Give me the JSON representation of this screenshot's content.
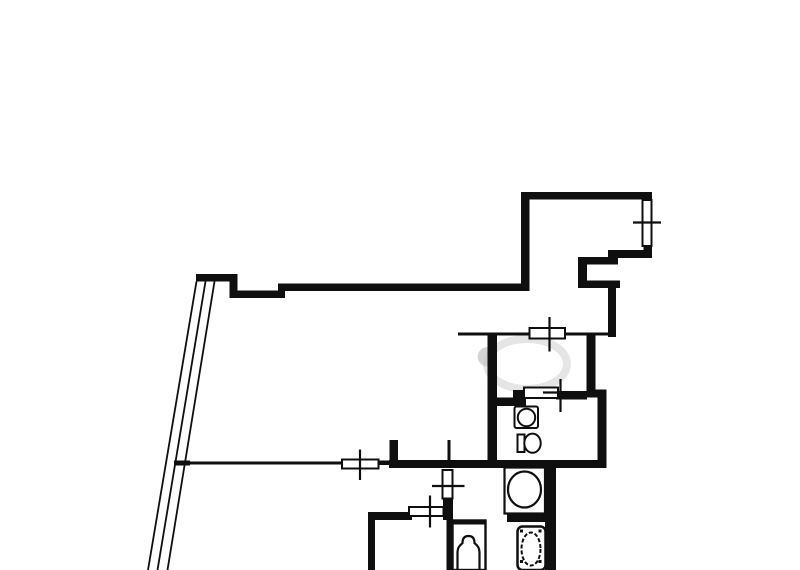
{
  "canvas": {
    "width": 800,
    "height": 570,
    "background": "#ffffff",
    "ink": "#0f0f0f"
  },
  "plan": {
    "description": "apartment-floor-plan",
    "layers": [
      {
        "name": "watermark",
        "shapes": [
          {
            "t": "e",
            "n": "watermark-ring",
            "cx": 527,
            "cy": 364,
            "rx": 40,
            "ry": 25,
            "sw": 8,
            "stroke": "#e5e5e5",
            "fill": "none"
          },
          {
            "t": "p",
            "n": "watermark-half-disc",
            "d": "M487.5,347 A9.5,9.5 0 0 0 487.5,366.5 Z",
            "fill": "#c8c8c8",
            "op": 0.8
          }
        ]
      },
      {
        "name": "walls-thick",
        "shapes": [
          {
            "t": "r",
            "n": "wall-roomA-top",
            "x": 521,
            "y": 192,
            "w": 131,
            "h": 7.5
          },
          {
            "t": "r",
            "n": "wall-roomA-left",
            "x": 521,
            "y": 192,
            "w": 8.5,
            "h": 99
          },
          {
            "t": "r",
            "n": "wall-roomA-right-top",
            "x": 643.5,
            "y": 192,
            "w": 8.5,
            "h": 10.5
          },
          {
            "t": "r",
            "n": "wall-roomA-right-bottom",
            "x": 643.5,
            "y": 245.5,
            "w": 8.5,
            "h": 12.5
          },
          {
            "t": "r",
            "n": "wall-roomA-bottom",
            "x": 608,
            "y": 250,
            "w": 44,
            "h": 8
          },
          {
            "t": "r",
            "n": "wall-step-a",
            "x": 608,
            "y": 250,
            "w": 10,
            "h": 14.5
          },
          {
            "t": "r",
            "n": "wall-step-b",
            "x": 578,
            "y": 257,
            "w": 40,
            "h": 7.5
          },
          {
            "t": "r",
            "n": "wall-step-c",
            "x": 578,
            "y": 257,
            "w": 9,
            "h": 31
          },
          {
            "t": "r",
            "n": "wall-step-d",
            "x": 578,
            "y": 280.5,
            "w": 42,
            "h": 7.5
          },
          {
            "t": "r",
            "n": "wall-hall-right-upper",
            "x": 608,
            "y": 280.5,
            "w": 8,
            "h": 56.5
          },
          {
            "t": "r",
            "n": "wall-main-top",
            "x": 281,
            "y": 283.5,
            "w": 248.5,
            "h": 7.5
          },
          {
            "t": "r",
            "n": "wall-notch-step",
            "x": 278,
            "y": 283.5,
            "w": 7,
            "h": 14.5
          },
          {
            "t": "r",
            "n": "wall-notch",
            "x": 233,
            "y": 290.5,
            "w": 48,
            "h": 7.5
          },
          {
            "t": "r",
            "n": "wall-notch-corner",
            "x": 229.5,
            "y": 274,
            "w": 8,
            "h": 24
          },
          {
            "t": "r",
            "n": "wall-left-stub",
            "x": 196,
            "y": 274,
            "w": 38.5,
            "h": 7.5
          },
          {
            "t": "r",
            "n": "wall-bottom-main",
            "x": 389,
            "y": 460,
            "w": 216.5,
            "h": 8
          },
          {
            "t": "r",
            "n": "wall-bottom-connector",
            "x": 377.5,
            "y": 460.5,
            "w": 13,
            "h": 4.5
          },
          {
            "t": "r",
            "n": "wall-door-stub",
            "x": 389.5,
            "y": 440,
            "w": 8.5,
            "h": 24
          },
          {
            "t": "r",
            "n": "wall-closet-right",
            "x": 586.5,
            "y": 335,
            "w": 9,
            "h": 57
          },
          {
            "t": "r",
            "n": "wall-step-low",
            "x": 586.5,
            "y": 389.5,
            "w": 20,
            "h": 8
          },
          {
            "t": "r",
            "n": "wall-right-lower",
            "x": 597.5,
            "y": 389.5,
            "w": 9,
            "h": 78.5
          },
          {
            "t": "r",
            "n": "wall-partition-vertical",
            "x": 487.5,
            "y": 333,
            "w": 9.5,
            "h": 134
          },
          {
            "t": "r",
            "n": "wall-wc-top",
            "x": 488,
            "y": 397.5,
            "w": 28,
            "h": 8.5
          },
          {
            "t": "r",
            "n": "wall-wc-top-step",
            "x": 513,
            "y": 390,
            "w": 13,
            "h": 16
          },
          {
            "t": "r",
            "n": "wall-wc-top-right",
            "x": 556,
            "y": 391,
            "w": 31,
            "h": 8.5
          },
          {
            "t": "r",
            "n": "wall-blroom-top",
            "x": 368,
            "y": 512,
            "w": 44,
            "h": 8
          },
          {
            "t": "r",
            "n": "wall-blroom-left",
            "x": 368,
            "y": 512,
            "w": 7,
            "h": 58
          },
          {
            "t": "r",
            "n": "wall-bath-corner",
            "x": 443,
            "y": 498,
            "w": 10,
            "h": 22
          },
          {
            "t": "r",
            "n": "wall-bath-left",
            "x": 446.5,
            "y": 515,
            "w": 6.5,
            "h": 55
          },
          {
            "t": "r",
            "n": "wall-right-bottom",
            "x": 545,
            "y": 468,
            "w": 11,
            "h": 102
          },
          {
            "t": "r",
            "n": "wall-washer-bar",
            "x": 507,
            "y": 514.5,
            "w": 38.5,
            "h": 7.5
          },
          {
            "t": "r",
            "n": "wall-tub-top-bar",
            "x": 452.5,
            "y": 520,
            "w": 33,
            "h": 4.5
          }
        ]
      },
      {
        "name": "walls-thin",
        "shapes": [
          {
            "t": "r",
            "n": "thinwall-bottom-left",
            "x": 175,
            "y": 461.5,
            "w": 167.5,
            "h": 3
          },
          {
            "t": "r",
            "n": "thinwall-end-tick",
            "x": 174,
            "y": 460.5,
            "w": 16,
            "h": 5
          },
          {
            "t": "r",
            "n": "thinwall-inner-a",
            "x": 458,
            "y": 332.5,
            "w": 74,
            "h": 3
          },
          {
            "t": "r",
            "n": "thinwall-inner-b",
            "x": 563,
            "y": 332.5,
            "w": 47,
            "h": 3
          },
          {
            "t": "r",
            "n": "thinwall-stub",
            "x": 447.5,
            "y": 440,
            "w": 3,
            "h": 22
          }
        ]
      },
      {
        "name": "balcony-glazing",
        "shapes": [
          {
            "t": "l",
            "n": "glazing-line-1",
            "x1": 196.5,
            "y1": 281.5,
            "x2": 148,
            "y2": 570,
            "sw": 1.8
          },
          {
            "t": "l",
            "n": "glazing-line-2",
            "x1": 205.5,
            "y1": 281.5,
            "x2": 157.5,
            "y2": 570,
            "sw": 1.8
          },
          {
            "t": "l",
            "n": "glazing-line-3",
            "x1": 214.5,
            "y1": 281.5,
            "x2": 167.5,
            "y2": 570,
            "sw": 1.8
          }
        ]
      },
      {
        "name": "window-symbols",
        "shapes": [
          {
            "t": "r",
            "n": "window-plate-roomA",
            "x": 642.5,
            "y": 200,
            "w": 9,
            "h": 46,
            "fill": "#ffffff",
            "sw": 2
          },
          {
            "t": "r",
            "n": "window-plate-closet",
            "x": 529.5,
            "y": 328,
            "w": 35.5,
            "h": 10.5,
            "fill": "#ffffff",
            "sw": 2
          },
          {
            "t": "r",
            "n": "window-plate-wc",
            "x": 524,
            "y": 387.5,
            "w": 34,
            "h": 10.5,
            "fill": "#ffffff",
            "sw": 2
          },
          {
            "t": "r",
            "n": "window-plate-main-bottom",
            "x": 342,
            "y": 459.5,
            "w": 36.5,
            "h": 9,
            "fill": "#ffffff",
            "sw": 2
          },
          {
            "t": "r",
            "n": "window-plate-vertical",
            "x": 442.5,
            "y": 470,
            "w": 10,
            "h": 28.5,
            "fill": "#ffffff",
            "sw": 2
          },
          {
            "t": "r",
            "n": "window-plate-blroom",
            "x": 409,
            "y": 507,
            "w": 34.5,
            "h": 9,
            "fill": "#ffffff",
            "sw": 2
          },
          {
            "t": "l",
            "n": "window-tick-roomA",
            "x1": 633,
            "y1": 222.5,
            "x2": 661,
            "y2": 222.5,
            "sw": 2.2
          },
          {
            "t": "l",
            "n": "window-tick-closet",
            "x1": 549.5,
            "y1": 317,
            "x2": 549.5,
            "y2": 351.5,
            "sw": 2.2
          },
          {
            "t": "l",
            "n": "window-tick-wc-v",
            "x1": 560.5,
            "y1": 379,
            "x2": 560.5,
            "y2": 412,
            "sw": 2.2
          },
          {
            "t": "l",
            "n": "window-tick-wc-h",
            "x1": 543,
            "y1": 392.5,
            "x2": 581,
            "y2": 392.5,
            "sw": 2.2
          },
          {
            "t": "l",
            "n": "window-tick-main-bottom",
            "x1": 360,
            "y1": 449.5,
            "x2": 360,
            "y2": 480,
            "sw": 2.2
          },
          {
            "t": "l",
            "n": "window-tick-vertical",
            "x1": 432,
            "y1": 486,
            "x2": 464.5,
            "y2": 486,
            "sw": 2.2
          },
          {
            "t": "l",
            "n": "window-tick-blroom",
            "x1": 430,
            "y1": 495.5,
            "x2": 430,
            "y2": 527.5,
            "sw": 2.2
          }
        ]
      },
      {
        "name": "fixtures",
        "shapes": [
          {
            "t": "r",
            "n": "sink-square",
            "x": 514.5,
            "y": 406.5,
            "w": 23.5,
            "h": 21.5,
            "fill": "#ffffff",
            "sw": 2,
            "rx": 2
          },
          {
            "t": "e",
            "n": "sink-bowl",
            "cx": 526.5,
            "cy": 417.5,
            "rx": 8.7,
            "ry": 8.7,
            "sw": 2,
            "fill": "#ffffff"
          },
          {
            "t": "r",
            "n": "toilet-tank",
            "x": 517.5,
            "y": 434.5,
            "w": 7,
            "h": 17.5,
            "fill": "#ffffff",
            "sw": 2
          },
          {
            "t": "e",
            "n": "toilet-bowl",
            "cx": 532.5,
            "cy": 443.2,
            "rx": 8.2,
            "ry": 9.6,
            "sw": 2,
            "fill": "#ffffff"
          },
          {
            "t": "r",
            "n": "washing-machine-square",
            "x": 504.5,
            "y": 467.5,
            "w": 40.5,
            "h": 46,
            "fill": "#ffffff",
            "sw": 2.2
          },
          {
            "t": "e",
            "n": "washing-machine-drum",
            "cx": 524.5,
            "cy": 489.5,
            "rx": 16.5,
            "ry": 18,
            "sw": 2.2,
            "fill": "#ffffff"
          },
          {
            "t": "r",
            "n": "bathtub-outline",
            "x": 452.5,
            "y": 520.5,
            "w": 33,
            "h": 49.5,
            "fill": "none",
            "sw": 2.4
          },
          {
            "t": "p",
            "n": "bathtub-inner",
            "d": "M457.5,570 L457.5,553 Q457.5,548 460,545.5 L462.5,543 Q462.5,536 468.5,536 Q474.5,536 474.5,543 L477,545.5 Q479.5,548 479.5,553 L479.5,570",
            "fill": "none",
            "sw": 2.2
          },
          {
            "t": "r",
            "n": "laundry-unit-outline",
            "x": 517.5,
            "y": 526.5,
            "w": 28,
            "h": 43.5,
            "fill": "#ffffff",
            "sw": 2.5,
            "rx": 5
          },
          {
            "t": "e",
            "n": "laundry-unit-basin",
            "cx": 531,
            "cy": 549,
            "rx": 9.5,
            "ry": 16.5,
            "sw": 2,
            "fill": "#ffffff",
            "dash": "4 2"
          },
          {
            "t": "r",
            "n": "laundry-corner-tl",
            "x": 520,
            "y": 529.5,
            "w": 3,
            "h": 3
          },
          {
            "t": "r",
            "n": "laundry-corner-tr",
            "x": 538.5,
            "y": 529.5,
            "w": 3,
            "h": 3
          },
          {
            "t": "r",
            "n": "laundry-corner-bl",
            "x": 520,
            "y": 560,
            "w": 3,
            "h": 3
          },
          {
            "t": "r",
            "n": "laundry-corner-br",
            "x": 538.5,
            "y": 560,
            "w": 3,
            "h": 3
          }
        ]
      }
    ]
  }
}
